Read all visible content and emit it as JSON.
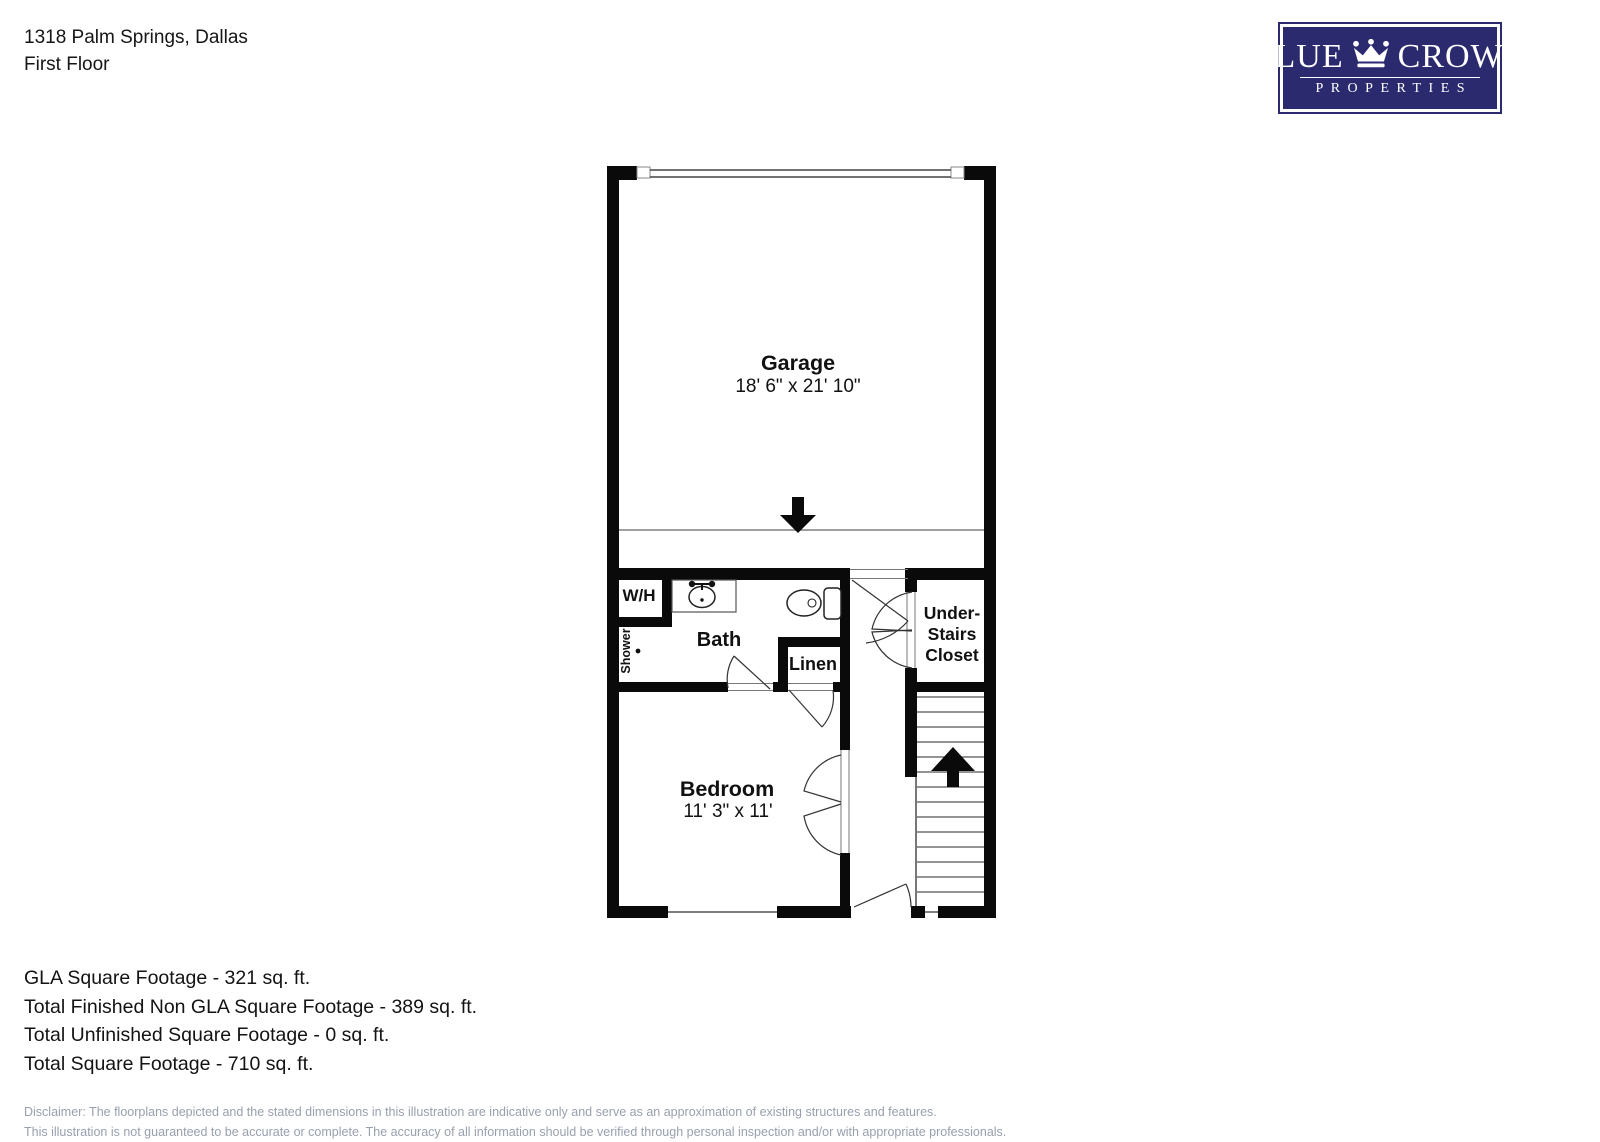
{
  "header": {
    "address": "1318 Palm Springs, Dallas",
    "floor": "First Floor"
  },
  "logo": {
    "word1": "BLUE",
    "word2": "CROWN",
    "word3": "PROPERTIES",
    "crown_icon": "crown-icon",
    "navy": "#2b2a6e"
  },
  "floorplan": {
    "rooms": {
      "garage": {
        "label": "Garage",
        "dims": "18' 6\" x 21' 10\""
      },
      "bedroom": {
        "label": "Bedroom",
        "dims": "11' 3\" x 11'"
      },
      "bath": {
        "label": "Bath"
      },
      "wh": {
        "label": "W/H"
      },
      "shower": {
        "label": "Shower"
      },
      "linen": {
        "label": "Linen"
      },
      "understairs": {
        "lines": [
          "Under-",
          "Stairs",
          "Closet"
        ]
      }
    }
  },
  "summary": {
    "lines": [
      "GLA Square Footage - 321 sq. ft.",
      "Total Finished Non GLA Square Footage - 389 sq. ft.",
      "Total Unfinished Square Footage - 0 sq. ft.",
      "Total Square Footage - 710 sq. ft."
    ]
  },
  "disclaimer": {
    "lines": [
      "Disclaimer: The floorplans depicted and the stated dimensions in this illustration are indicative only and serve as an approximation of existing structures and features.",
      "This illustration is not guaranteed to be accurate or complete. The accuracy of all information should be verified through personal inspection and/or with appropriate professionals."
    ],
    "gray": "#98a0ae"
  }
}
